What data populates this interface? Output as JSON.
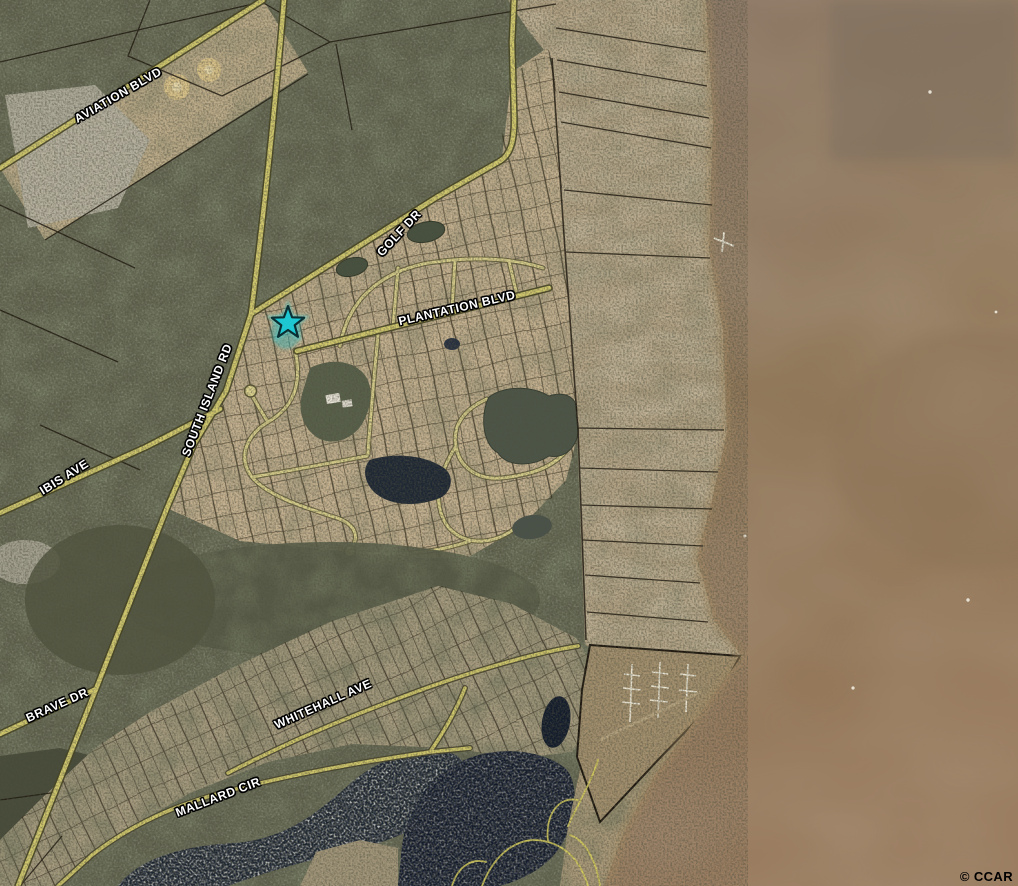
{
  "map": {
    "type": "satellite-parcel-map",
    "street_labels": [
      {
        "id": "aviation-blvd",
        "text": "AVIATION BLVD",
        "x": 118,
        "y": 95,
        "rotation": -30
      },
      {
        "id": "golf-dr",
        "text": "GOLF DR",
        "x": 399,
        "y": 233,
        "rotation": -47
      },
      {
        "id": "plantation-blvd",
        "text": "PLANTATION BLVD",
        "x": 457,
        "y": 308,
        "rotation": -13
      },
      {
        "id": "south-island-rd",
        "text": "SOUTH ISLAND RD",
        "x": 207,
        "y": 400,
        "rotation": -69
      },
      {
        "id": "ibis-ave",
        "text": "IBIS AVE",
        "x": 64,
        "y": 477,
        "rotation": -32
      },
      {
        "id": "brave-dr",
        "text": "BRAVE DR",
        "x": 57,
        "y": 705,
        "rotation": -24
      },
      {
        "id": "whitehall-ave",
        "text": "WHITEHALL AVE",
        "x": 323,
        "y": 704,
        "rotation": -24
      },
      {
        "id": "mallard-cir",
        "text": "MALLARD CIR",
        "x": 218,
        "y": 797,
        "rotation": -21
      }
    ],
    "marker": {
      "shape": "star",
      "x": 288,
      "y": 323,
      "fill": "#1EC8D2",
      "outline": "#0B2F33"
    },
    "watermark": {
      "text": "© CCAR"
    },
    "palette": {
      "water": "#8E7760",
      "marsh": "#B3A284",
      "parcel_tan": "#C6B291",
      "forest": "#5C5F4B",
      "road": "#D2C96E",
      "lake": "#15202E",
      "parcel_line": "#241C10",
      "marker_glow": "#3FE2E4"
    }
  }
}
